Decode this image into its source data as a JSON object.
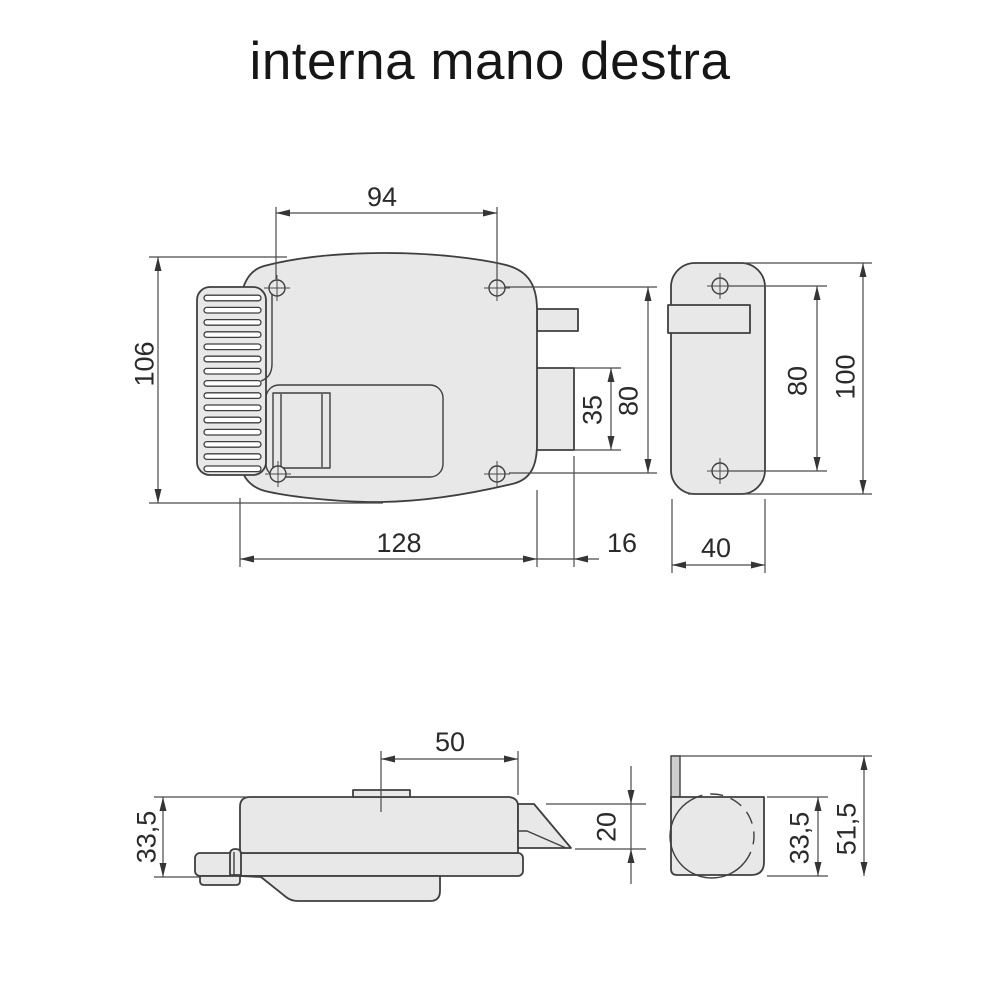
{
  "title": "interna mano destra",
  "views": [
    {
      "id": "front-view",
      "dims": [
        {
          "name": "hole-spacing-horizontal",
          "value": "94"
        },
        {
          "name": "overall-height",
          "value": "106"
        },
        {
          "name": "body-width",
          "value": "128"
        },
        {
          "name": "latch-projection",
          "value": "16"
        },
        {
          "name": "latch-height",
          "value": "35"
        },
        {
          "name": "hole-spacing-vertical",
          "value": "80"
        }
      ]
    },
    {
      "id": "strike-plate-front-view",
      "dims": [
        {
          "name": "hole-spacing-vertical",
          "value": "80"
        },
        {
          "name": "plate-height",
          "value": "100"
        },
        {
          "name": "plate-width",
          "value": "40"
        }
      ]
    },
    {
      "id": "bottom-view",
      "dims": [
        {
          "name": "tab-offset",
          "value": "50"
        },
        {
          "name": "body-depth",
          "value": "33,5"
        },
        {
          "name": "latch-depth",
          "value": "20"
        }
      ]
    },
    {
      "id": "strike-plate-side-view",
      "dims": [
        {
          "name": "box-depth",
          "value": "33,5"
        },
        {
          "name": "overall-depth",
          "value": "51,5"
        }
      ]
    }
  ],
  "colors": {
    "part_fill": "#e8e8e8",
    "outline": "#3f3f3f",
    "dimension_lines": "#4a4a4a",
    "label_text": "#1f1f1f",
    "background": "#ffffff"
  }
}
